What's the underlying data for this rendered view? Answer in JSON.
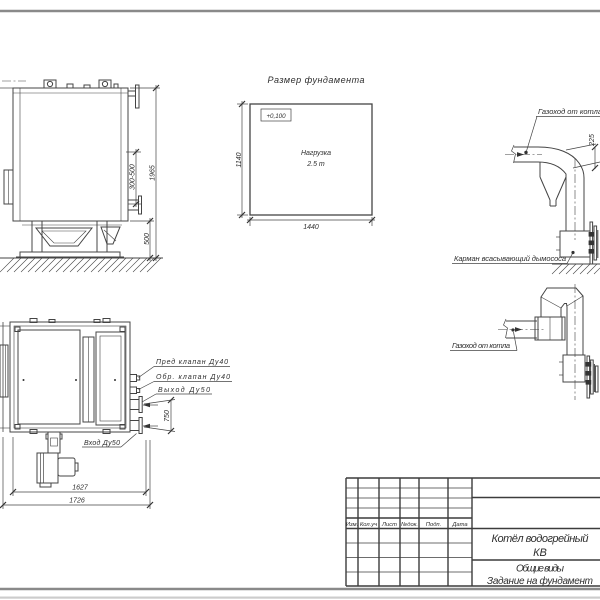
{
  "side_view": {
    "dim_total_height": "1965",
    "dim_outlet_height": "300-500",
    "dim_base_height": "500"
  },
  "foundation_plan": {
    "title": "Размер фундамента",
    "elevation_mark": "+0,100",
    "load_line1": "Нагрузка",
    "load_line2": "2.5 т",
    "dim_width": "1440",
    "dim_depth": "1140"
  },
  "flue_upper": {
    "label_duct": "Газоход от котла",
    "dim_duct": "225",
    "label_pocket": "Карман всасывающий дымососа"
  },
  "flue_lower": {
    "label_duct": "Газоход от котла"
  },
  "plan_view": {
    "label_safety_valve": "Пред клапан Ду40",
    "label_check_valve": "Обр. клапан Ду40",
    "label_outlet": "Выход Ду50",
    "label_inlet": "Вход Ду50",
    "dim_pipe_spacing": "750",
    "dim_length_inner": "1627",
    "dim_length_outer": "1726"
  },
  "title_block": {
    "columns": [
      "Изм.",
      "Кол.уч",
      "Лист",
      "№док.",
      "Подп.",
      "Дата"
    ],
    "doc_title_line1": "Котёл водогрейный",
    "doc_title_line2": "КВ",
    "doc_subtitle_line1": "Общие виды",
    "doc_subtitle_line2": "Задание на фундамент"
  },
  "colors": {
    "line": "#444444",
    "page_edge": "#8a8a8a"
  }
}
